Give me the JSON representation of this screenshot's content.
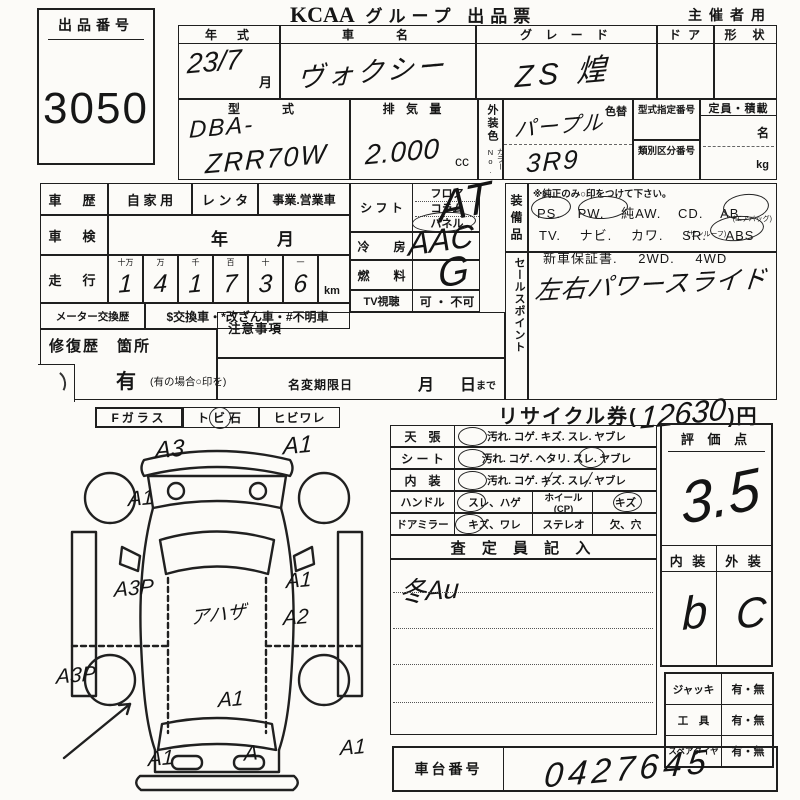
{
  "sheet": {
    "auction_no_label": "出品番号",
    "auction_no": "3050",
    "brand": "KCAA",
    "title": "グループ 出品票",
    "organizer": "主催者用"
  },
  "vehicle": {
    "year_label": "年　式",
    "year_value": "23/7",
    "month_suffix": "月",
    "name_label": "車　　名",
    "name_value": "ヴォクシー",
    "grade_label": "グ レ ー ド",
    "grade_value": "ZS 煌",
    "door_label": "ド ア",
    "shape_label": "形　状",
    "model_label": "型　　式",
    "model_prefix": "DBA-",
    "model_code": "ZRR70W",
    "disp_label": "排 気 量",
    "disp_value": "2.000",
    "disp_unit": "cc",
    "ext_color_label": "外装色",
    "color_no_label": "カラーNo.",
    "color_value": "パープル",
    "color_no_value": "3R9",
    "color_change_label": "色替",
    "type_cert_label": "型式指定番号",
    "class_no_label": "類別区分番号",
    "capacity_label": "定員・積載",
    "capacity_persons": "名",
    "capacity_kg": "kg"
  },
  "history": {
    "label": "車　歴",
    "private": "自 家 用",
    "rental": "レ ン タ",
    "business": "事業.営業車",
    "inspection_label": "車　検",
    "year": "年",
    "month": "月",
    "mileage_label": "走　行",
    "digit_headers": [
      "十万",
      "万",
      "千",
      "百",
      "十",
      "一"
    ],
    "digits": [
      "1",
      "4",
      "1",
      "7",
      "3",
      "6"
    ],
    "unit": "km",
    "meter_label": "メーター交換歴",
    "meter_note": "$交換車・*改ざん車・#不明車",
    "repair_label": "修復歴　箇所",
    "repair_yes": "有",
    "repair_note": "(有の場合○印を)",
    "caution_label": "注意事項",
    "name_change_label": "名変期限日",
    "nc_month": "月",
    "nc_day": "日",
    "nc_until": "まで"
  },
  "specs": {
    "shift_label": "シ フ ト",
    "shift_opts": [
      "フロア",
      "コラム",
      "パネル"
    ],
    "shift_value": "AT",
    "ac_label": "冷　　房",
    "ac_value": "AAC",
    "fuel_label": "燃　　料",
    "fuel_value": "G",
    "tv_label": "TV視聴",
    "tv_opts": "可 ・ 不可"
  },
  "equipment": {
    "label": "装備品",
    "note": "※純正のみ○印をつけて下さい。",
    "row1": [
      "PS.",
      "PW.",
      "純AW.",
      "CD.",
      "AB"
    ],
    "row1_sub": "(エアバッグ)",
    "row2": [
      "TV.",
      "ナビ.",
      "カワ.",
      "SR.",
      "ABS"
    ],
    "row2_sub": "(サンルーフ)",
    "row3": [
      "新車保証書.",
      "2WD.",
      "4WD"
    ]
  },
  "sales": {
    "label": "セールスポイント",
    "value": "左右パワースライド"
  },
  "recycle": {
    "prefix": "リサイクル券(",
    "amount": "12630",
    "suffix": ")円"
  },
  "glass": {
    "f": "Fガラス",
    "stone": "トビ石",
    "crack": "ヒビワレ"
  },
  "diagram": {
    "roof_note": "アハザ",
    "marks": [
      "A3",
      "A1",
      "A1",
      "A3P",
      "A1",
      "A2",
      "A3P",
      "A1",
      "A1",
      "A1",
      "A"
    ]
  },
  "condition": {
    "rows": [
      {
        "label": "天　張",
        "opts": "汚れ. コゲ. キズ. スレ. ヤブレ"
      },
      {
        "label": "シ ー ト",
        "opts": "汚れ. コゲ. ヘタリ. スレ. ヤブレ"
      },
      {
        "label": "内　装",
        "opts": "汚れ. コゲ. キズ. スレ. ヤブレ"
      }
    ],
    "handle_label": "ハンドル",
    "handle_opts": "スレ、ハゲ",
    "wheel_label": "ホイール(CP)",
    "wheel_opt": "キズ",
    "mirror_label": "ドアミラー",
    "mirror_opts": "キズ、ワレ",
    "stereo_label": "ステレオ",
    "stereo_opt": "欠、穴",
    "inspector_header": "査 定 員 記 入",
    "inspector_note": "冬Au"
  },
  "rating": {
    "score_label": "評 価 点",
    "score": "3.5",
    "interior_label": "内 装",
    "exterior_label": "外 装",
    "interior": "b",
    "exterior": "C"
  },
  "accessories": [
    {
      "label": "ジャッキ",
      "value": "有・無"
    },
    {
      "label": "工　具",
      "value": "有・無"
    },
    {
      "label": "スペアタイヤ",
      "value": "有・無"
    }
  ],
  "chassis": {
    "label": "車台番号",
    "value": "0427645"
  }
}
